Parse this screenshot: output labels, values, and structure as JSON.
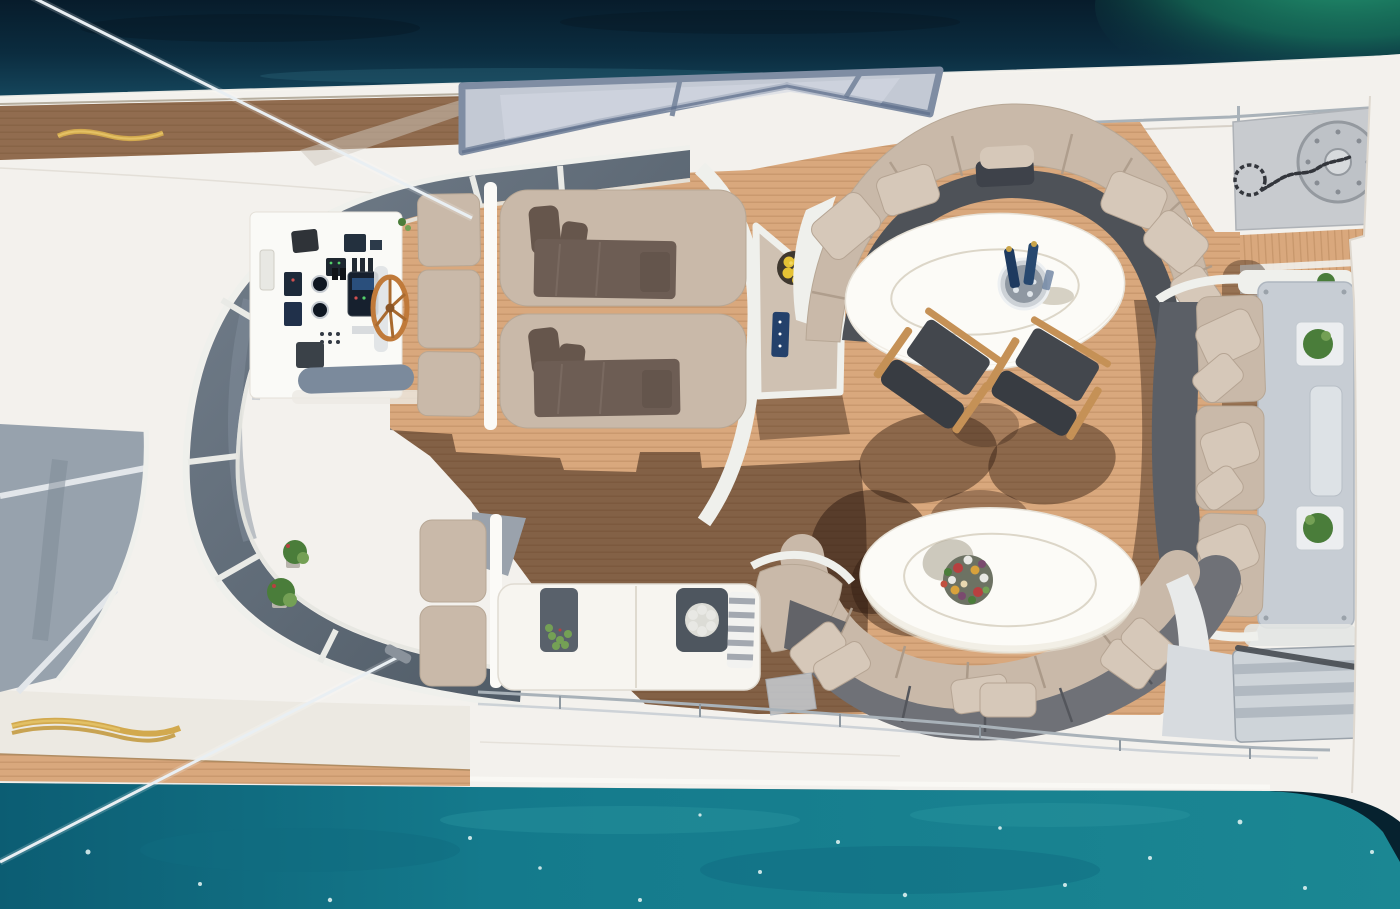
{
  "scene": {
    "alt": "Aerial top-down photograph of a luxury motor yacht flybridge deck anchored in teal water",
    "type": "aerial-photograph",
    "objects": [
      "sea water (dark navy above bow, turquoise below stern)",
      "white yacht hull crossing frame diagonally",
      "teak deck with plank lines and large cast shadows",
      "curved helm windshield with white ribs",
      "helm console with instruments and wooden steering wheel",
      "two sun loungers with brown towels and backrest cushions",
      "corner drinks table with bowl of lemons and blue tray",
      "forward dining area: curved beige sofa around white oval table with ice bucket and wine bottles",
      "two director chairs with wooden frames",
      "aft lounge: curved sofa (beige seats, grey backs) around second white oval table with flower centerpiece",
      "starboard straight sofa with scatter pillows and planter console with two green plants",
      "bar counter with succulent, white flower bowl and striped towel, plus cushioned bench",
      "anchor chain laid on grey platform with round winch",
      "teak steps and side stairs",
      "two rigging wires, yellow mooring ropes, stainless rails",
      "water sparkles on turquoise sea"
    ]
  },
  "counts": {
    "sun_loungers": 2,
    "oval_tables": 2,
    "director_chairs": 2,
    "sofas": 3,
    "planters": 6,
    "rigging_wires": 2
  },
  "colors": {
    "water_top_deep": "#071c2b",
    "water_top_mid": "#0b2c3f",
    "water_top_light": "#15465c",
    "water_green": "#1c8f69",
    "water_green_bright": "#2aa87d",
    "water_bottom_left": "#0c5d73",
    "water_bottom_mid": "#147a8c",
    "water_bottom_right": "#1b8793",
    "sparkle": "#e8f7f5",
    "hull_white": "#f3f1ed",
    "white_bright": "#fbfaf7",
    "white_trim": "#eff0ec",
    "seam_gray": "#d9d3c9",
    "teak_light": "#d9a87d",
    "teak_line": "#b9895e",
    "teak_shadow": "#2e1a10",
    "glass_dark": "#49545f",
    "glass_mid": "#74808d",
    "glass_light": "#c3c9d4",
    "frame_blue": "#7f8da3",
    "windshield_rib": "#e9eae6",
    "cushion_beige": "#c9b9a9",
    "cushion_beige_light": "#d6c8b9",
    "cushion_separator": "#ab9a89",
    "seat_dark": "#4e5258",
    "sofa_gray": "#6f7177",
    "pillow_dark": "#66564c",
    "towel_brown": "#6d5d54",
    "table_white": "#fcfbf7",
    "table_ring": "#dcd6c8",
    "wood_wheel": "#c07a3a",
    "chair_wood": "#c59156",
    "chair_fabric": "#43474d",
    "console_gray": "#c7cdd4",
    "platform_gray": "#c8cbcf",
    "steel": "#a9b2b9",
    "chain_dark": "#33363c",
    "lemon": "#e5c235",
    "plant_green": "#4a7d3a",
    "plant_green_light": "#74a055",
    "flower_red": "#b84040",
    "flower_white": "#e8e8e4",
    "navy": "#24416b",
    "rope_yellow": "#d2a94e",
    "stair_light": "#ced4d9",
    "stair_dark": "#aab2ba",
    "wire_white": "#e9eff3"
  }
}
